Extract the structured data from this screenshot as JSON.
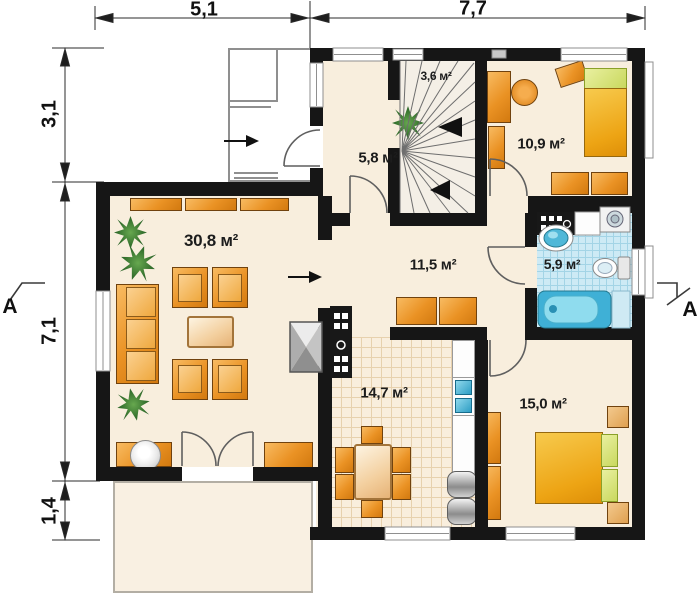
{
  "dimensions": {
    "top": [
      {
        "label": "5,1"
      },
      {
        "label": "7,7"
      }
    ],
    "left": [
      {
        "label": "3,1"
      },
      {
        "label": "7,1"
      },
      {
        "label": "1,4"
      }
    ]
  },
  "section_markers": {
    "left": "A",
    "right": "A"
  },
  "rooms": {
    "hall": {
      "area_label": "5,8 м²"
    },
    "staircase": {
      "area_label": "3,6 м²"
    },
    "bedroom_small": {
      "area_label": "10,9 м²"
    },
    "living_room": {
      "area_label": "30,8 м²"
    },
    "corridor": {
      "area_label": "11,5 м²"
    },
    "bathroom": {
      "area_label": "5,9 м²"
    },
    "kitchen": {
      "area_label": "14,7 м²"
    },
    "bedroom_main": {
      "area_label": "15,0 м²"
    }
  },
  "colors": {
    "walls": "#161616",
    "floor_cream": "#f8eedd",
    "furniture_orange": "#ea9224",
    "bed_yellow": "#eda414",
    "pillow_green": "#c9d85e",
    "bathroom_tile_blue": "#cdeaf5",
    "bathtub_blue": "#3fb0d6",
    "kitchen_tile": "#f9eedd",
    "plant_green": "#35712e",
    "appliance_gray": "#a9a9a9"
  }
}
